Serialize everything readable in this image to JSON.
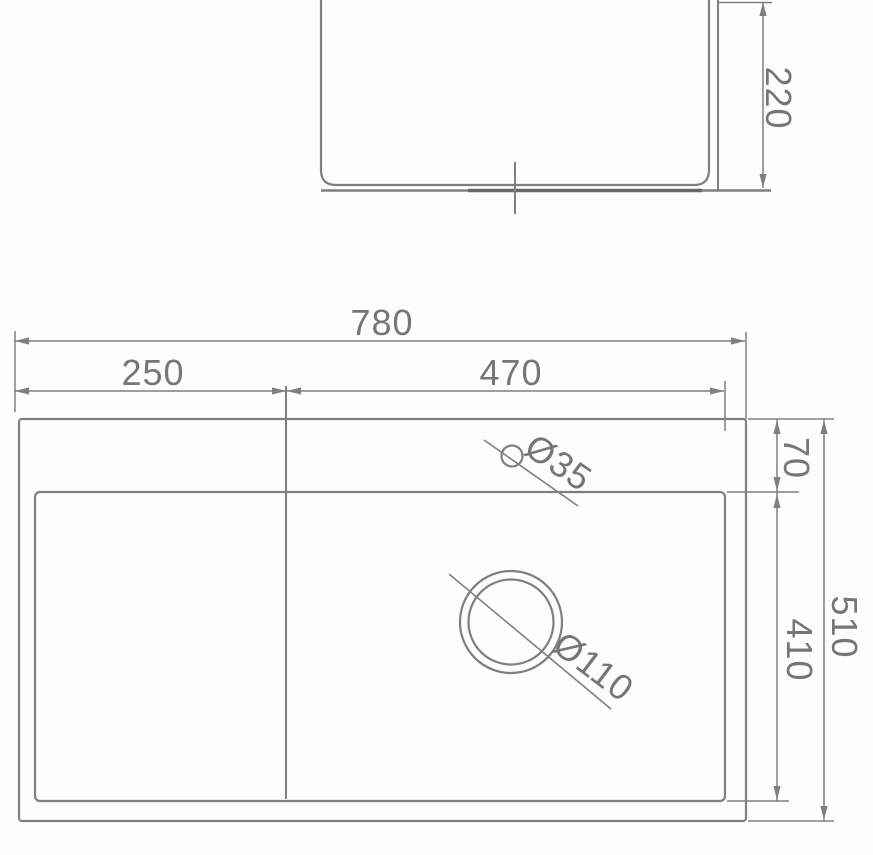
{
  "colors": {
    "line": "#7f7f7f",
    "dark_line": "#686868",
    "text": "#767676",
    "background": "#fdfdfd"
  },
  "side_view": {
    "depth_label": "220"
  },
  "plan_view": {
    "overall_width_label": "780",
    "left_section_width_label": "250",
    "bowl_width_label": "470",
    "rim_depth_label": "70",
    "bowl_depth_label": "410",
    "overall_depth_label": "510",
    "faucet_hole_diameter_label": "Ø35",
    "drain_hole_diameter_label": "Ø110"
  }
}
